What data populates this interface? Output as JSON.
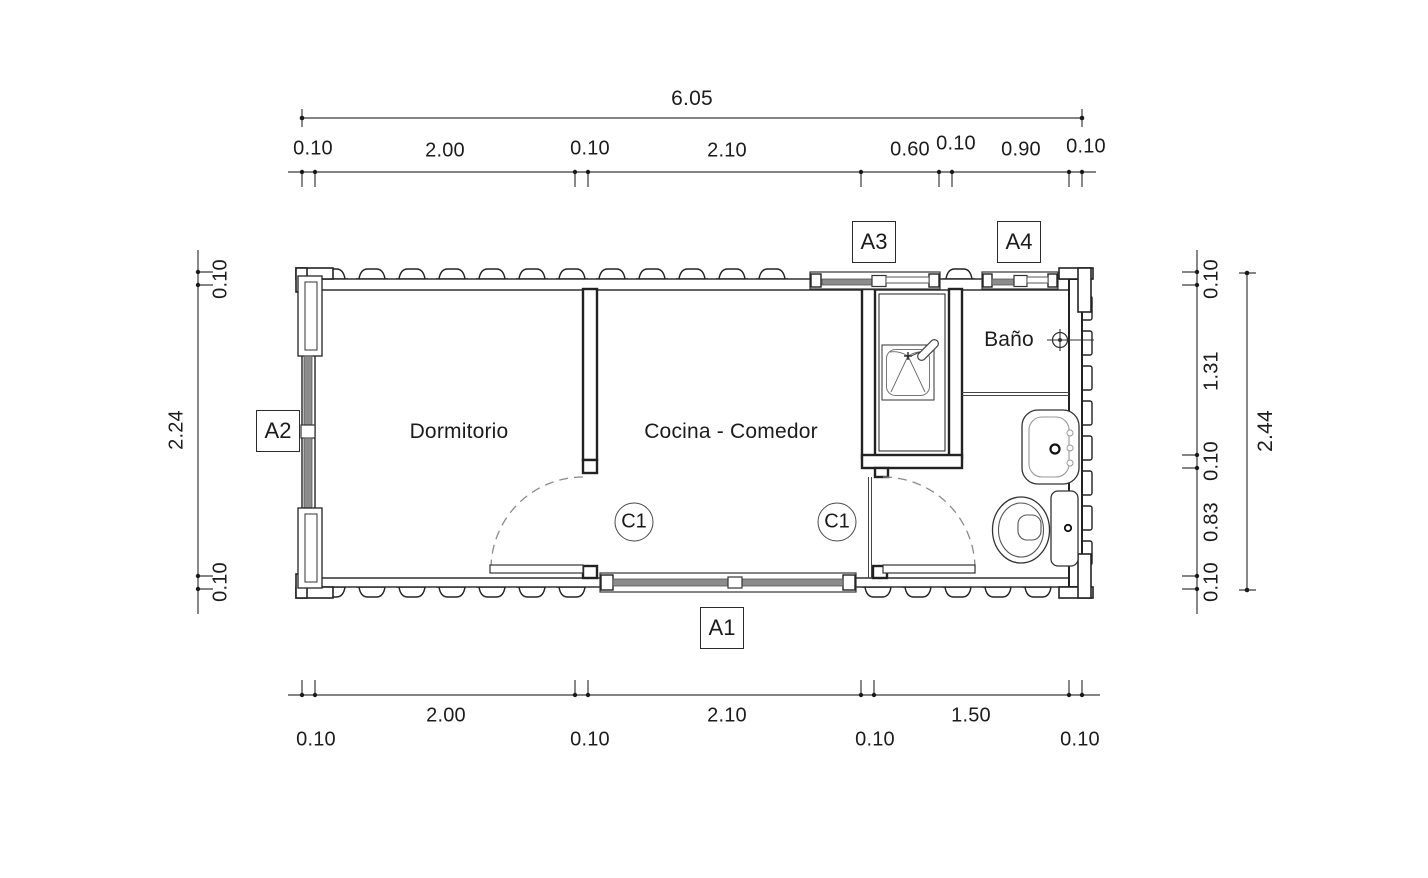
{
  "plan": {
    "rooms": {
      "bedroom": "Dormitorio",
      "kitchen": "Cocina - Comedor",
      "bathroom": "Baño"
    },
    "door_tags": {
      "kitchen_door": "C1",
      "bath_door": "C1"
    },
    "opening_tags": {
      "a1": "A1",
      "a2": "A2",
      "a3": "A3",
      "a4": "A4"
    },
    "dims": {
      "top_total": "6.05",
      "top_chain": [
        "0.10",
        "2.00",
        "0.10",
        "2.10",
        "0.60",
        "0.10",
        "0.90",
        "0.10"
      ],
      "bottom_chain": [
        "0.10",
        "2.00",
        "0.10",
        "2.10",
        "0.10",
        "1.50",
        "0.10"
      ],
      "left_chain": [
        "0.10",
        "2.24",
        "0.10"
      ],
      "right_chain": [
        "0.10",
        "1.31",
        "0.10",
        "0.83",
        "0.10"
      ],
      "right_total": "2.44"
    },
    "colors": {
      "line": "#222222",
      "glazing": "#8c8c8c",
      "dashed_arc": "#8a8a8a",
      "background": "#ffffff"
    }
  }
}
